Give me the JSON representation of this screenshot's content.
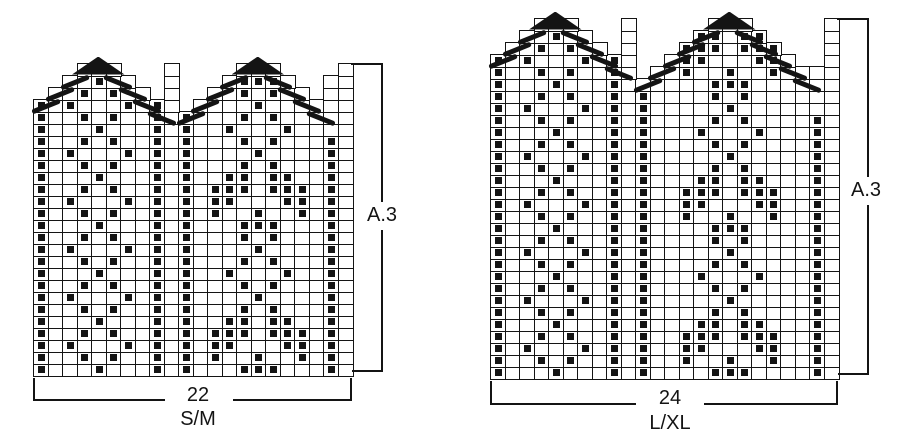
{
  "page": {
    "background": "#ffffff",
    "ink_color": "#141414",
    "description_labels": [
      "22",
      "S/M",
      "24",
      "L/XL",
      "A.3"
    ]
  },
  "charts": [
    {
      "id": "chart-sm",
      "labels": {
        "stitches": "22",
        "size": "S/M",
        "motif": "A.3"
      },
      "cols": 22,
      "rows": 26,
      "geom": {
        "x0": 33,
        "y_bottom": 375,
        "cell_w": 14.5,
        "cell_h": 12,
        "side_label_frac": 0.49
      },
      "grid_rows_bottom_up": [
        "#...#...#.#...###...#.",
        "#..#.#..#.#.#..#..#.#.",
        "#.#...#.#.#.##...##.#.",
        "#..#.#..#.#.###.###.#.",
        "#...#...#.#..##.##..#.",
        "#..#.#..#.#...#.#...#.",
        "#.#...#.#.#....#....#.",
        "#..#.#..#.#...#.#...#.",
        "#...#...#.#..#...#..#.",
        "#..#.#..#.#...#.#...#.",
        "#.#...#.#.#....#....#.",
        "#..#.#..#.#...#.#...#.",
        "#...#...#.#...###...#.",
        "#..#.#..#.#.#..#..#.#.",
        "#.#...#.#.#.##...##.#.",
        "#..#.#..#.#.###.###.#.",
        "#...#...#.#..##.##..#.",
        "#..#.#..#.#...#.#...#.",
        "#.#...#.#.#....#....#.",
        "#..#.#..#.#...#.#...#.",
        "#...#...#.#..#...#....",
        "#..#.#..#.#...#.#.....",
        "#.#...#.#. ....#......",
        " ..#.#.. .  ..#.#.. ..",
        "  ..#..  .   .###.  ..",
        "   ...   .    ...    ."
      ],
      "triangles": [
        {
          "col_start": 4,
          "row": 26
        },
        {
          "col_start": 15,
          "row": 26
        }
      ],
      "decrease_bars": [
        {
          "c": 1,
          "r": 23,
          "d": "up"
        },
        {
          "c": 2,
          "r": 24,
          "d": "up"
        },
        {
          "c": 3,
          "r": 25,
          "d": "up"
        },
        {
          "c": 6,
          "r": 25,
          "d": "down"
        },
        {
          "c": 7,
          "r": 24,
          "d": "down"
        },
        {
          "c": 8,
          "r": 23,
          "d": "down"
        },
        {
          "c": 9,
          "r": 22,
          "d": "down"
        },
        {
          "c": 11,
          "r": 22,
          "d": "up"
        },
        {
          "c": 12,
          "r": 23,
          "d": "up"
        },
        {
          "c": 13,
          "r": 24,
          "d": "up"
        },
        {
          "c": 14,
          "r": 25,
          "d": "up"
        },
        {
          "c": 17,
          "r": 25,
          "d": "down"
        },
        {
          "c": 18,
          "r": 24,
          "d": "down"
        },
        {
          "c": 19,
          "r": 23,
          "d": "down"
        },
        {
          "c": 20,
          "r": 22,
          "d": "down"
        }
      ]
    },
    {
      "id": "chart-lxl",
      "labels": {
        "stitches": "24",
        "size": "L/XL",
        "motif": "A.3"
      },
      "cols": 24,
      "rows": 30,
      "geom": {
        "x0": 490,
        "y_bottom": 378,
        "cell_w": 14.5,
        "cell_h": 12,
        "side_label_frac": 0.48
      },
      "grid_rows_bottom_up": [
        "#...#...#.#....###....#.",
        "#..#.#..#.#..#..#..#..#.",
        "#.#...#.#.#..##...##..#.",
        "#..#.#..#.#..###.###..#.",
        "#...#...#.#...##.##...#.",
        "#..#.#..#.#....#.#....#.",
        "#.#...#.#.#.....#.....#.",
        "#..#.#..#.#....#.#....#.",
        "#...#...#.#...#...#...#.",
        "#..#.#..#.#....#.#....#.",
        "#.#...#.#.#.....#.....#.",
        "#..#.#..#.#....#.#....#.",
        "#...#...#.#....###....#.",
        "#..#.#..#.#..#..#..#..#.",
        "#.#...#.#.#..##...##..#.",
        "#..#.#..#.#..###.###..#.",
        "#...#...#.#...##.##...#.",
        "#..#.#..#.#....#.#....#.",
        "#.#...#.#.#.....#.....#.",
        "#..#.#..#.#....#.#....#.",
        "#...#...#.#...#...#...#.",
        "#..#.#..#.#....#.#....#.",
        "#.#...#.#.#.....#.......",
        "#..#.#..#.#....#.#......",
        "#...#...#......###......",
        "#..#.#..#. ..#..#..#....",
        "#.#...#.#.  .##...##.  .",
        " ..#.#.. .   ###.###   .",
        "  ..#..  .    ##.##    .",
        "   ...   .     ...     ."
      ],
      "triangles": [
        {
          "col_start": 4,
          "row": 30
        },
        {
          "col_start": 16,
          "row": 30
        }
      ],
      "decrease_bars": [
        {
          "c": 1,
          "r": 27,
          "d": "up"
        },
        {
          "c": 2,
          "r": 28,
          "d": "up"
        },
        {
          "c": 3,
          "r": 29,
          "d": "up"
        },
        {
          "c": 6,
          "r": 29,
          "d": "down"
        },
        {
          "c": 7,
          "r": 28,
          "d": "down"
        },
        {
          "c": 8,
          "r": 27,
          "d": "down"
        },
        {
          "c": 9,
          "r": 26,
          "d": "down"
        },
        {
          "c": 11,
          "r": 25,
          "d": "up"
        },
        {
          "c": 12,
          "r": 26,
          "d": "up"
        },
        {
          "c": 13,
          "r": 27,
          "d": "up"
        },
        {
          "c": 14,
          "r": 28,
          "d": "up"
        },
        {
          "c": 15,
          "r": 29,
          "d": "up"
        },
        {
          "c": 18,
          "r": 29,
          "d": "down"
        },
        {
          "c": 19,
          "r": 28,
          "d": "down"
        },
        {
          "c": 20,
          "r": 27,
          "d": "down"
        },
        {
          "c": 21,
          "r": 26,
          "d": "down"
        },
        {
          "c": 22,
          "r": 25,
          "d": "down"
        }
      ]
    }
  ]
}
